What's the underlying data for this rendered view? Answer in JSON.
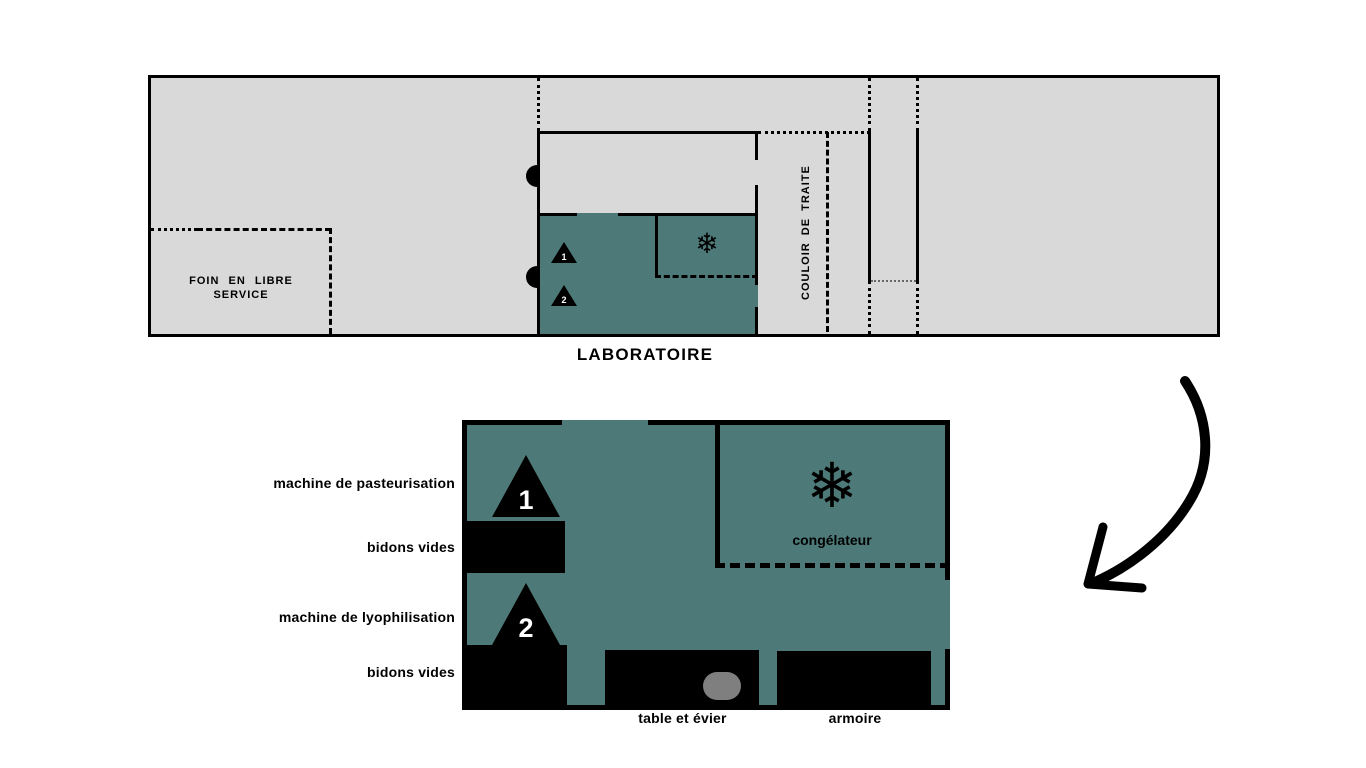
{
  "colors": {
    "teal": "#4d7a78",
    "plan_gray": "#d9d9d9",
    "sink_gray": "#7f7f7f",
    "wall": "#000000"
  },
  "overview": {
    "hay_label": "FOIN EN LIBRE SERVICE",
    "corridor_label": "COULOIR DE TRAITE",
    "title": "LABORATOIRE",
    "triangle1": "1",
    "triangle2": "2",
    "snowflake": "❄"
  },
  "detail": {
    "left_labels": [
      {
        "label": "machine de pasteurisation"
      },
      {
        "label": "bidons vides"
      },
      {
        "label": "machine de lyophilisation"
      },
      {
        "label": "bidons vides"
      }
    ],
    "freezer_label": "congélateur",
    "bottom_labels": [
      {
        "label": "table et évier"
      },
      {
        "label": "armoire"
      }
    ],
    "triangle1": "1",
    "triangle2": "2",
    "snowflake": "❄"
  }
}
